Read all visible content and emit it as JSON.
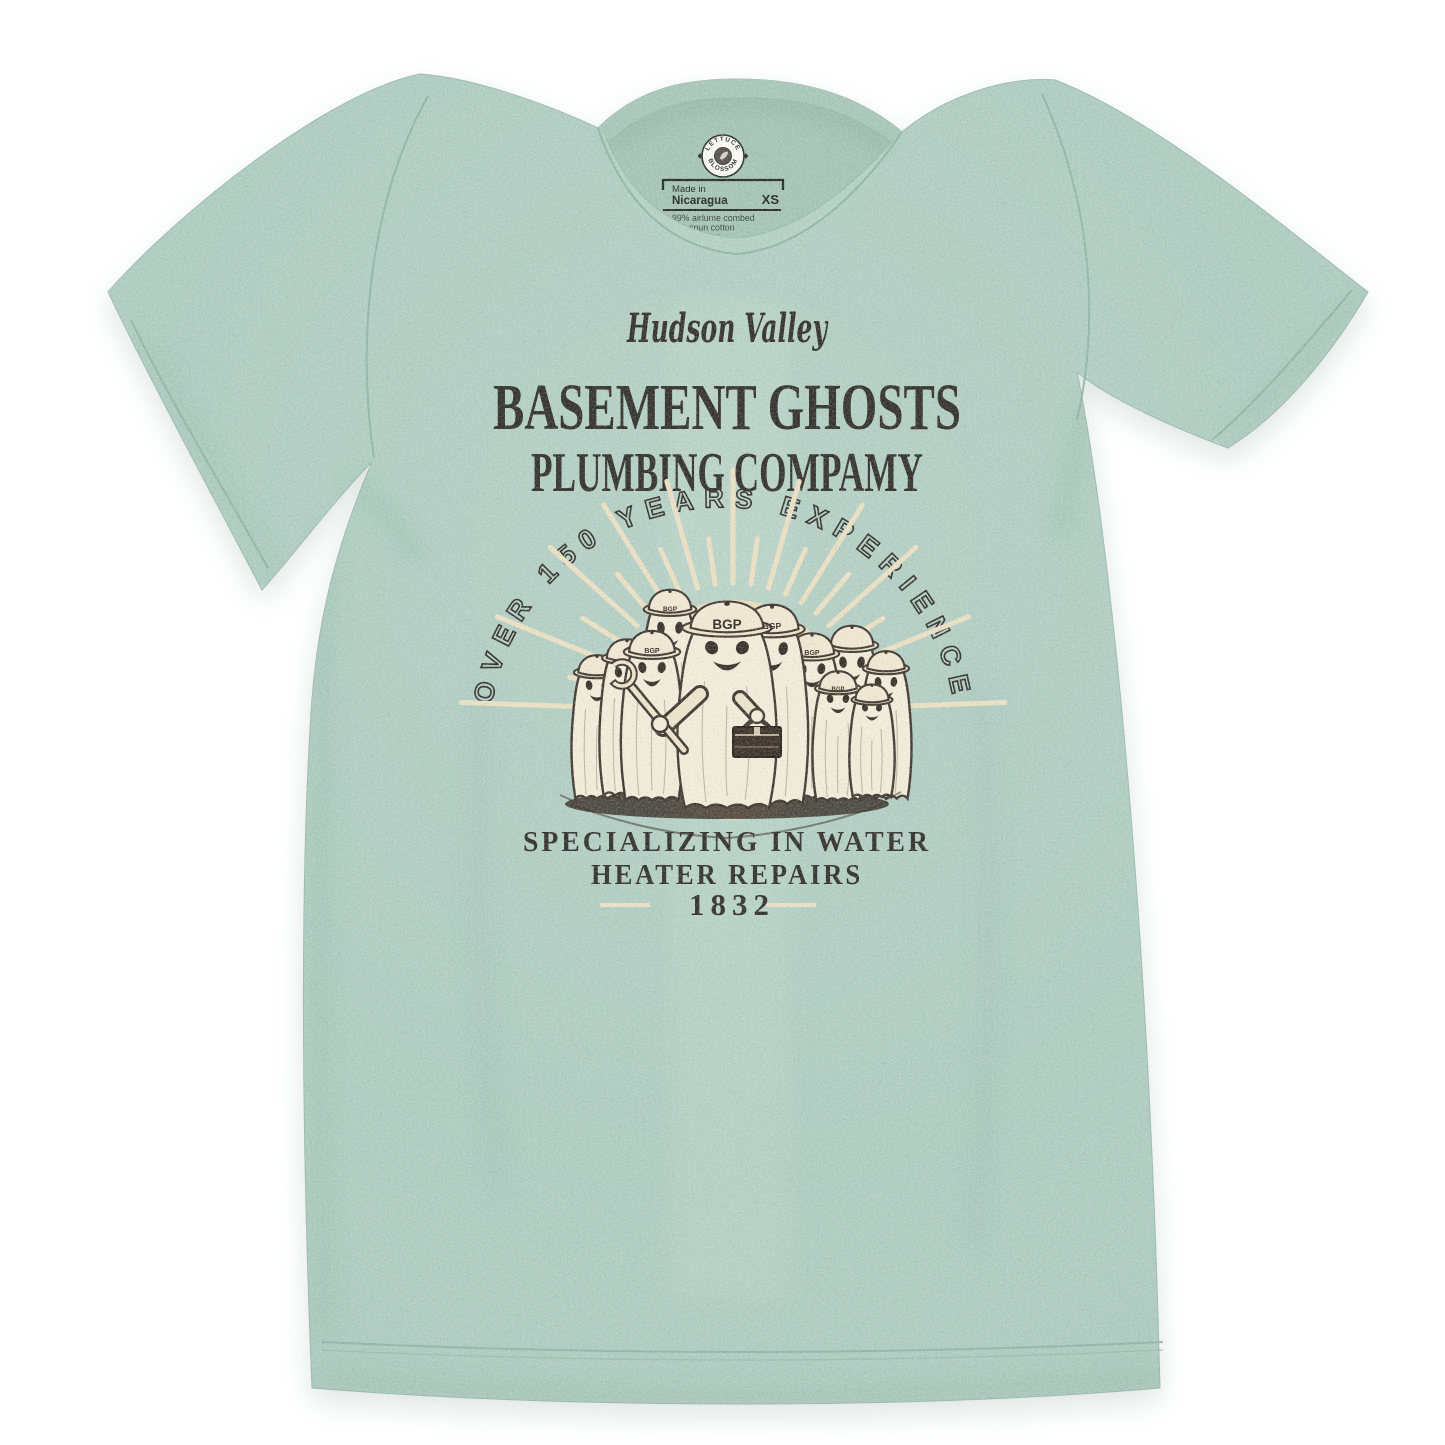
{
  "colors": {
    "background": "#ffffff",
    "shirt": "#adcbc0",
    "shirt_seam": "#8fb0a4",
    "print_ink": "#2f2b27",
    "print_cream": "#ecdfc2",
    "sun": "#ecdcba",
    "ghost_fill": "#f4ecd9",
    "illustration_outline": "#3c332b",
    "label_ink": "#232825"
  },
  "neck_label": {
    "brand_arc_top": "LETTUCE",
    "brand_arc_bottom": "BLOSSOM",
    "logo_center_icon": "leaf-icon",
    "made_in": "Made in",
    "country": "Nicaragua",
    "size": "XS",
    "fabric_line1": "99% airlume combed",
    "fabric_line2": "ring spun cotton",
    "fabric_line3": "ester"
  },
  "print": {
    "region_script": "Hudson Valley",
    "title_line1": "BASEMENT GHOSTS",
    "title_line2": "PLUMBING COMPAMY",
    "arc_text": "OVER 150 YEARS EXPERIENCE",
    "cap_text": "BGP",
    "tagline_line1": "SPECIALIZING IN WATER",
    "tagline_line2": "HEATER REPAIRS",
    "year": "1832"
  }
}
